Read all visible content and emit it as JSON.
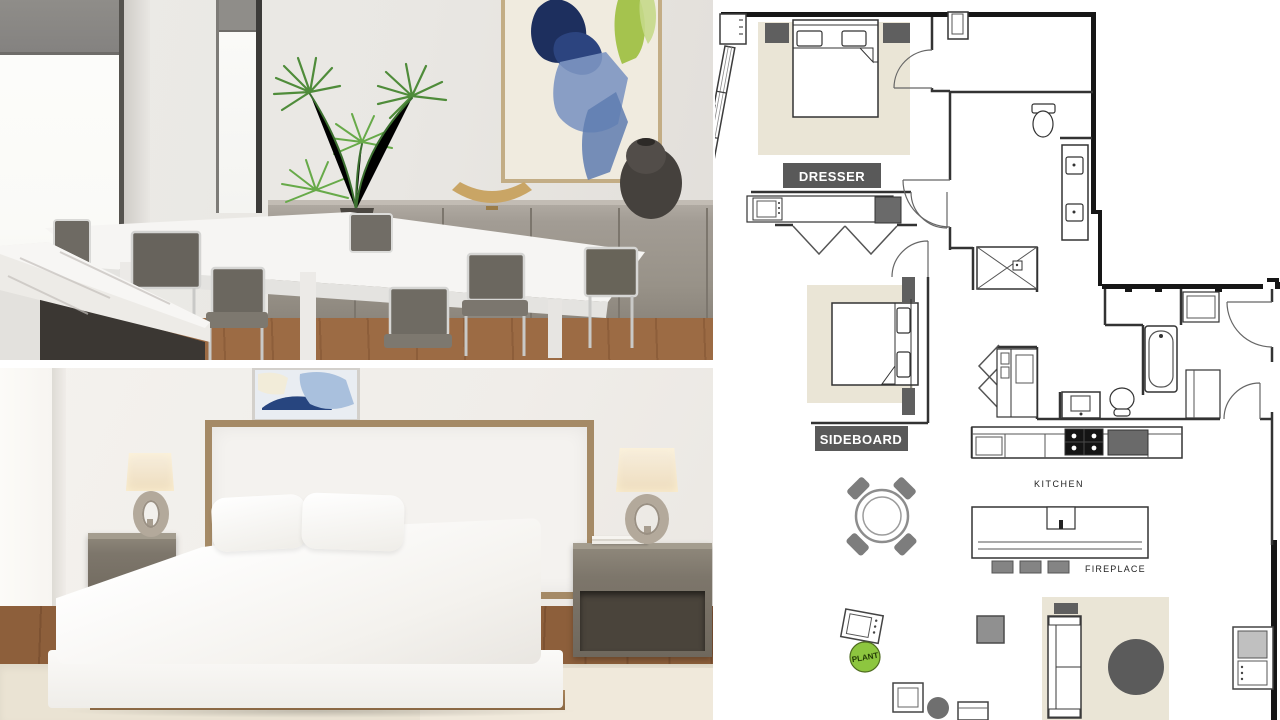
{
  "floorplan": {
    "labels": {
      "dresser": "DRESSER",
      "sideboard": "SIDEBOARD",
      "kitchen": "KITCHEN",
      "fireplace": "FIREPLACE",
      "plant": "PLANT"
    },
    "colors": {
      "outer_wall": "#161616",
      "wall_line": "#333333",
      "rug_beige": "#eae5d6",
      "furniture_dark_gray": "#5f5f5f",
      "stool_gray": "#848484",
      "plant_green": "#8dc63f",
      "label_bg": "#595959",
      "label_text": "#ffffff"
    }
  },
  "photos": {
    "dining": {
      "name": "dining-room-rendering"
    },
    "bedroom": {
      "name": "bedroom-rendering"
    }
  }
}
